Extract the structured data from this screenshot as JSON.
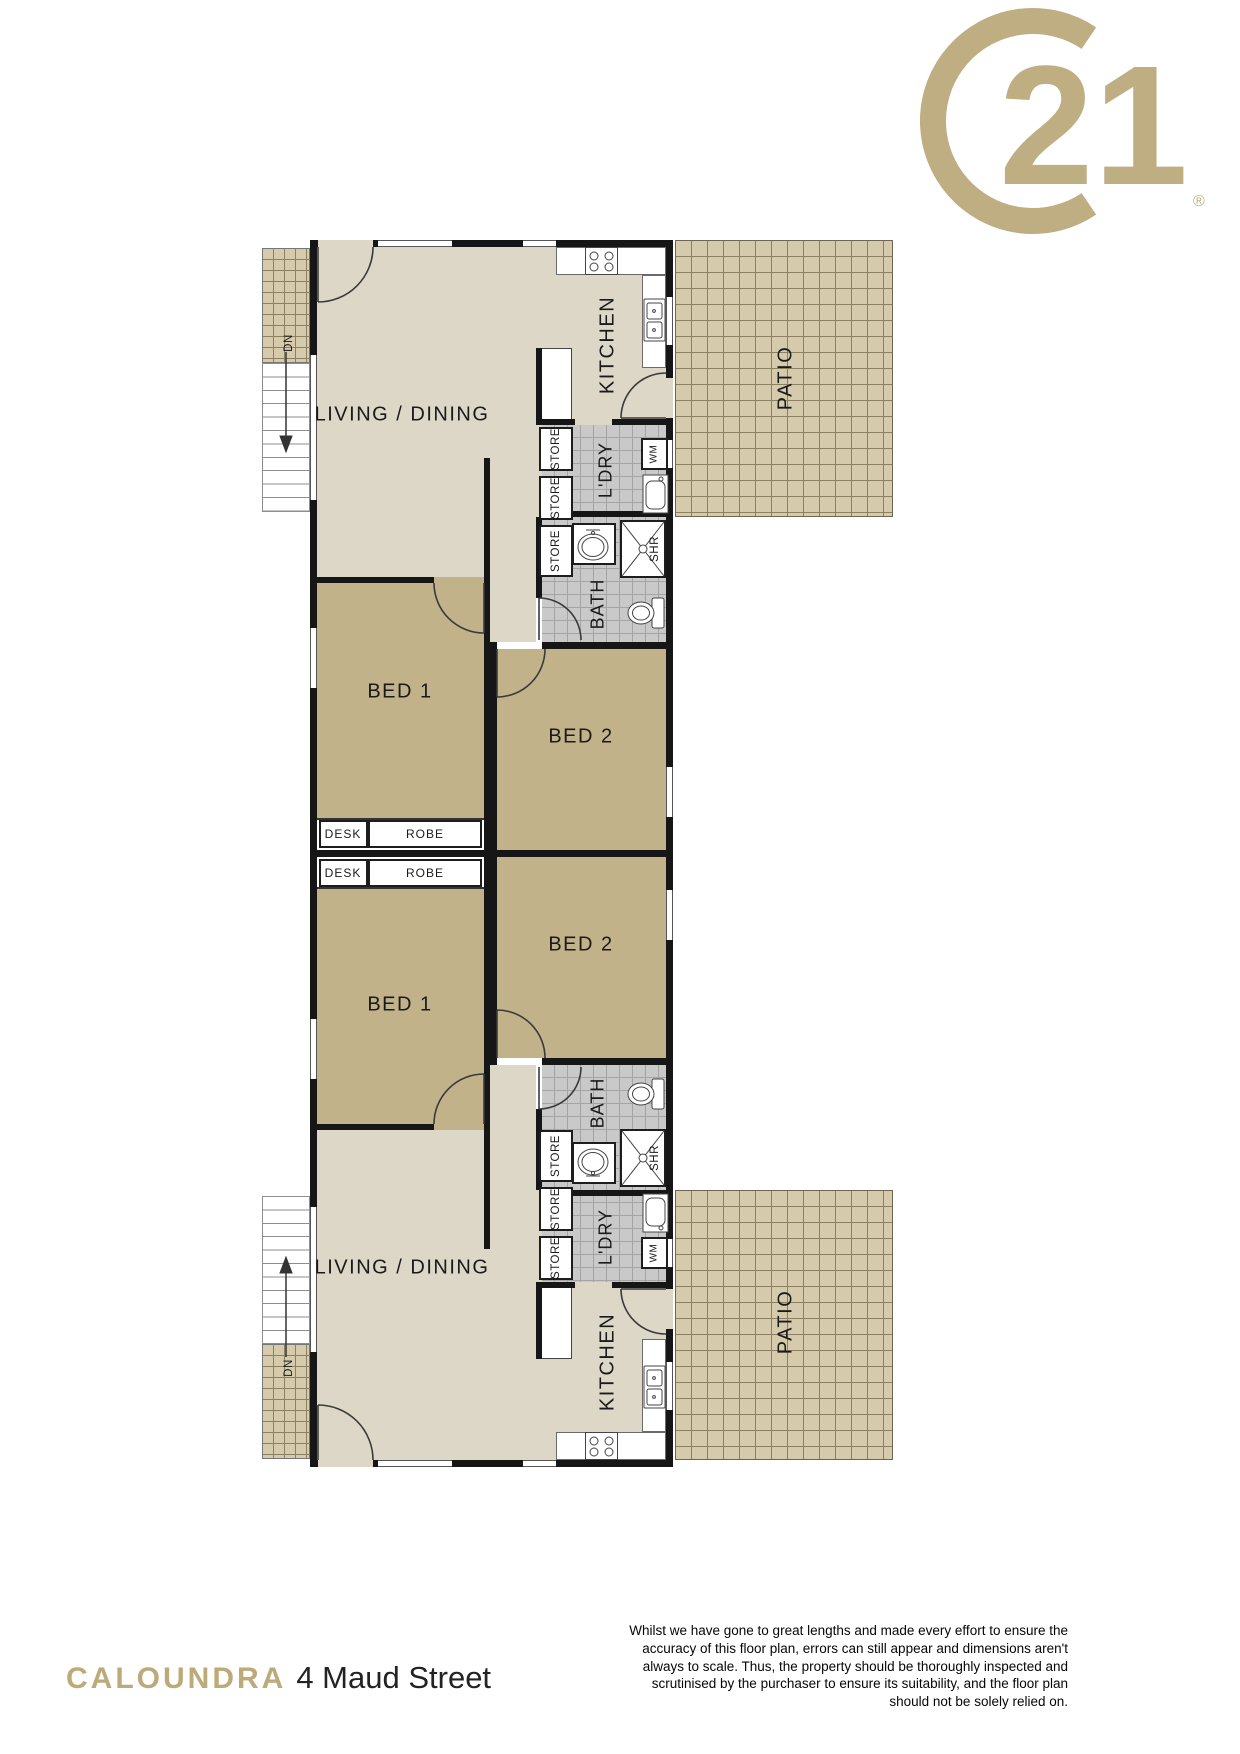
{
  "logo": {
    "number": "21",
    "registered": "®"
  },
  "plan": {
    "rooms": {
      "living": "LIVING / DINING",
      "kitchen": "KITCHEN",
      "patio": "PATIO",
      "laundry": "L'DRY",
      "bath": "BATH",
      "bed1": "BED 1",
      "bed2": "BED 2"
    },
    "fixtures": {
      "store": "STORE",
      "shower": "SHR",
      "washing_machine": "WM",
      "desk": "DESK",
      "robe": "ROBE",
      "stairs_down": "DN"
    }
  },
  "footer": {
    "suburb": "CALOUNDRA",
    "address": "4 Maud Street",
    "disclaimer_lines": [
      "Whilst we have gone to great lengths and made every effort to ensure the",
      "accuracy of this floor plan, errors can still appear and dimensions aren't",
      "always to scale. Thus, the property should be thoroughly inspected and",
      "scrutinised by the purchaser to ensure its suitability, and the floor plan",
      "should not be solely relied on."
    ]
  },
  "colors": {
    "gold": "#BFAE81",
    "wall": "#161616",
    "floor_living": "#DCD7C6",
    "floor_bed": "#C2B28A",
    "tile_wet": "#C9C9C9",
    "tile_patio": "#D5CBAC"
  }
}
